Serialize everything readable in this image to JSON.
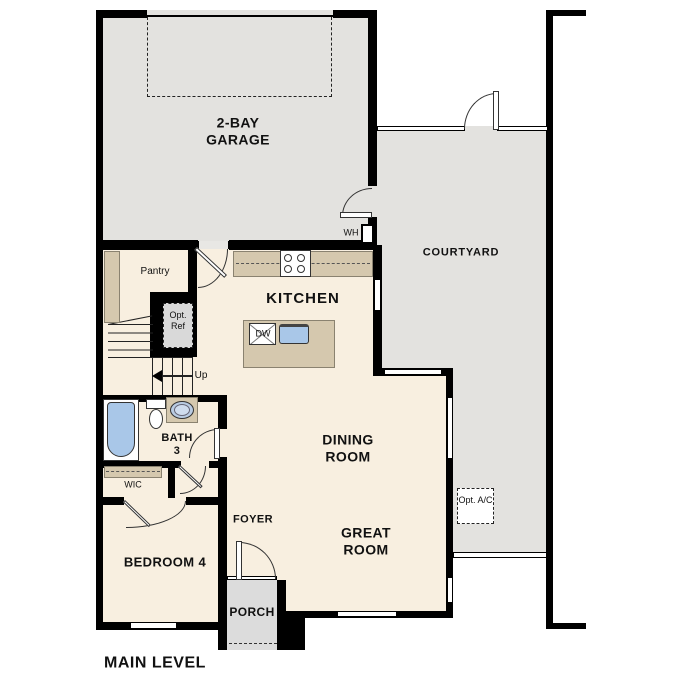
{
  "title": "MAIN LEVEL",
  "rooms": {
    "garage": {
      "line1": "2-BAY",
      "line2": "GARAGE"
    },
    "courtyard": {
      "label": "COURTYARD"
    },
    "kitchen": {
      "label": "KITCHEN"
    },
    "pantry": {
      "label": "Pantry"
    },
    "dining": {
      "line1": "DINING",
      "line2": "ROOM"
    },
    "great": {
      "line1": "GREAT",
      "line2": "ROOM"
    },
    "foyer": {
      "label": "FOYER"
    },
    "bath3": {
      "line1": "BATH",
      "line2": "3"
    },
    "wic": {
      "label": "WIC"
    },
    "bedroom4": {
      "label": "BEDROOM 4"
    },
    "porch": {
      "label": "PORCH"
    }
  },
  "fixtures": {
    "water_heater": "WH",
    "dishwasher": "DW",
    "stairs_up": "Up",
    "opt_ref": {
      "line1": "Opt.",
      "line2": "Ref"
    },
    "opt_ac": {
      "line1": "Opt.",
      "line2": "A/C"
    }
  },
  "colors": {
    "wall": "#000000",
    "outdoor": "#e3e2df",
    "porch": "#dcdcdc",
    "floor": "#f8efe0",
    "counter": "#d5c8ae",
    "water": "#a9c7e8",
    "optref": "#d9d9d9"
  }
}
